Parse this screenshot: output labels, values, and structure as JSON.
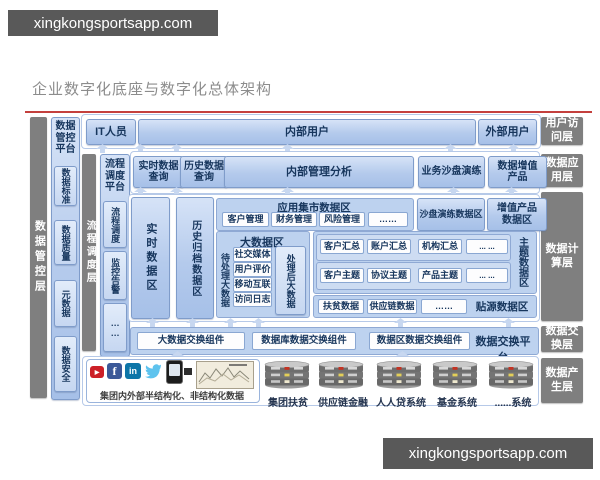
{
  "watermarks": {
    "top": "xingkongsportsapp.com",
    "bottom": "xingkongsportsapp.com"
  },
  "title": "企业数字化底座与数字化总体架构",
  "colors": {
    "accent_red": "#c4403d",
    "layer_gray": "#7f7f7f",
    "box_blue": "#b7cdee",
    "navy_text": "#17365d"
  },
  "left": {
    "governance_layer": "数据管控层",
    "governance_platform": {
      "title": "数据管控平台",
      "items": [
        "数据标准",
        "数据质量",
        "元数据",
        "数据安全"
      ]
    },
    "scheduling_layer": "流程调度层",
    "scheduling_platform": {
      "title": "流程调度平台",
      "items": [
        "流程调度",
        "监控告警",
        "……"
      ]
    }
  },
  "right_layers": [
    "用户访问层",
    "数据应用层",
    "数据计算层",
    "数据交换层",
    "数据产生层"
  ],
  "row_users": {
    "it": "IT人员",
    "internal": "内部用户",
    "external": "外部用户"
  },
  "row_apps": {
    "realtime_query": "实时数据查询",
    "history_query": "历史数据查询",
    "mgmt_analysis": "内部管理分析",
    "sandbox": "业务沙盘演练",
    "value_products": "数据增值产品"
  },
  "compute": {
    "realtime_zone": "实时数据区",
    "archive_zone": "历史归档数据区",
    "app_mart": {
      "title": "应用集市数据区",
      "items": [
        "客户管理",
        "财务管理",
        "风险管理",
        "……"
      ]
    },
    "sandbox_zone": "沙盘演练数据区",
    "value_zone": "增值产品数据区",
    "bigdata": {
      "title": "大数据区",
      "pending": "待处理大数据",
      "sources": [
        "社交媒体",
        "用户评价",
        "移动互联",
        "访问日志"
      ],
      "processed": "处理后大数据"
    },
    "theme": {
      "label": "主题数据区",
      "summary_row": [
        "客户汇总",
        "账户汇总",
        "机构汇总",
        "... ..."
      ],
      "topic_row": [
        "客户主题",
        "协议主题",
        "产品主题",
        "... ..."
      ]
    },
    "source": {
      "label": "贴源数据区",
      "items": [
        "扶贫数据",
        "供应链数据",
        "……"
      ]
    }
  },
  "exchange": {
    "components": [
      "大数据交换组件",
      "数据库数据交换组件",
      "数据区数据交换组件"
    ],
    "platform": "数据交换平台"
  },
  "producers": {
    "caption": "集团内外部半结构化、非结构化数据",
    "systems": [
      "集团扶贫",
      "供应链金融",
      "人人贷系统",
      "基金系统",
      "......系统"
    ]
  }
}
